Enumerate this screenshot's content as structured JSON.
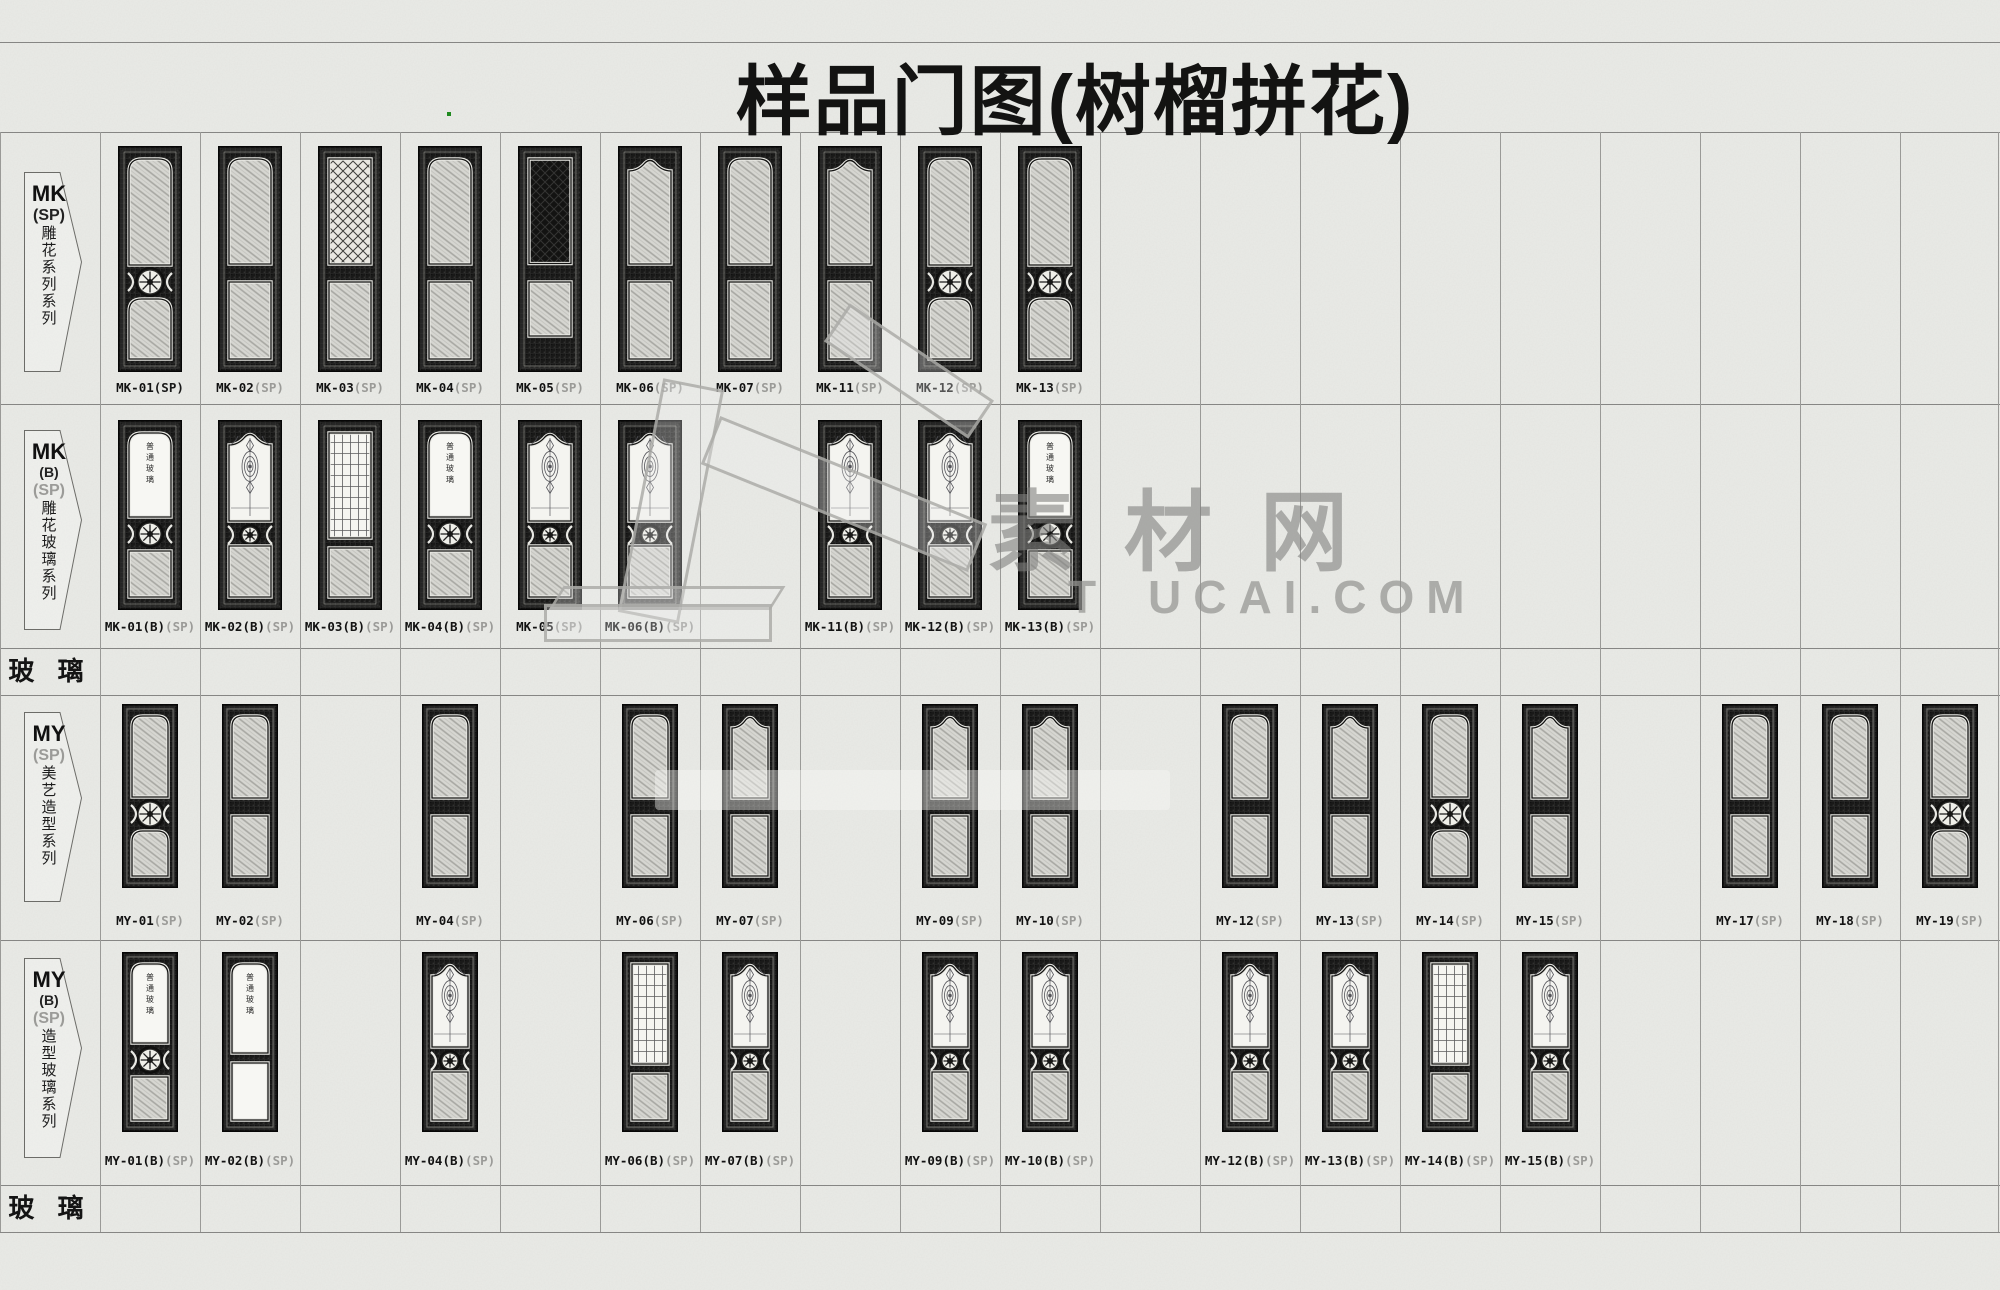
{
  "page_title": "样品门图(树榴拼花)",
  "glass_row_label": "玻 璃",
  "glass_pane_text": "普通玻璃",
  "watermark": {
    "cn_text": "素材网",
    "latin_fragment_1": "T",
    "latin_fragment_2": "UCAI.COM"
  },
  "rows": [
    {
      "id": "mk-sp",
      "badge": {
        "code": "MK",
        "variant": "",
        "series": "(SP)",
        "series_gray": false,
        "vertical": "雕花系列系列"
      },
      "doors": [
        {
          "col": 1,
          "name": "MK-01",
          "suffix": "(SP)",
          "style": "panel-rosette",
          "suffix_dark": true
        },
        {
          "col": 2,
          "name": "MK-02",
          "suffix": "(SP)",
          "style": "panel-plain"
        },
        {
          "col": 3,
          "name": "MK-03",
          "suffix": "(SP)",
          "style": "lattice"
        },
        {
          "col": 4,
          "name": "MK-04",
          "suffix": "(SP)",
          "style": "panel-plain"
        },
        {
          "col": 5,
          "name": "MK-05",
          "suffix": "(SP)",
          "style": "solid"
        },
        {
          "col": 6,
          "name": "MK-06",
          "suffix": "(SP)",
          "style": "panel-arch"
        },
        {
          "col": 7,
          "name": "MK-07",
          "suffix": "(SP)",
          "style": "panel-plain"
        },
        {
          "col": 8,
          "name": "MK-11",
          "suffix": "(SP)",
          "style": "panel-arch"
        },
        {
          "col": 9,
          "name": "MK-12",
          "suffix": "(SP)",
          "style": "panel-rosette"
        },
        {
          "col": 10,
          "name": "MK-13",
          "suffix": "(SP)",
          "style": "panel-rosette"
        }
      ]
    },
    {
      "id": "mk-b-sp",
      "badge": {
        "code": "MK",
        "variant": "(B)",
        "series": "(SP)",
        "series_gray": true,
        "vertical": "雕花玻璃系列"
      },
      "doors": [
        {
          "col": 1,
          "name": "MK-01(B)",
          "suffix": "(SP)",
          "style": "glass-plain",
          "pane_text": true
        },
        {
          "col": 2,
          "name": "MK-02(B)",
          "suffix": "(SP)",
          "style": "glass-ornate"
        },
        {
          "col": 3,
          "name": "MK-03(B)",
          "suffix": "(SP)",
          "style": "glass-lattice"
        },
        {
          "col": 4,
          "name": "MK-04(B)",
          "suffix": "(SP)",
          "style": "glass-plain",
          "pane_text": true
        },
        {
          "col": 5,
          "name": "MK-05",
          "suffix": "(SP)",
          "style": "glass-ornate"
        },
        {
          "col": 6,
          "name": "MK-06(B)",
          "suffix": "(SP)",
          "style": "glass-ornate"
        },
        {
          "col": 8,
          "name": "MK-11(B)",
          "suffix": "(SP)",
          "style": "glass-ornate"
        },
        {
          "col": 9,
          "name": "MK-12(B)",
          "suffix": "(SP)",
          "style": "glass-ornate"
        },
        {
          "col": 10,
          "name": "MK-13(B)",
          "suffix": "(SP)",
          "style": "glass-plain",
          "pane_text": true
        }
      ]
    },
    {
      "id": "my-sp",
      "badge": {
        "code": "MY",
        "variant": "",
        "series": "(SP)",
        "series_gray": true,
        "vertical": "美艺造型系列"
      },
      "doors": [
        {
          "col": 1,
          "name": "MY-01",
          "suffix": "(SP)",
          "style": "panel-rosette"
        },
        {
          "col": 2,
          "name": "MY-02",
          "suffix": "(SP)",
          "style": "panel-plain"
        },
        {
          "col": 4,
          "name": "MY-04",
          "suffix": "(SP)",
          "style": "panel-plain"
        },
        {
          "col": 6,
          "name": "MY-06",
          "suffix": "(SP)",
          "style": "panel-plain"
        },
        {
          "col": 7,
          "name": "MY-07",
          "suffix": "(SP)",
          "style": "panel-arch"
        },
        {
          "col": 9,
          "name": "MY-09",
          "suffix": "(SP)",
          "style": "panel-arch"
        },
        {
          "col": 10,
          "name": "MY-10",
          "suffix": "(SP)",
          "style": "panel-arch"
        },
        {
          "col": 12,
          "name": "MY-12",
          "suffix": "(SP)",
          "style": "panel-plain"
        },
        {
          "col": 13,
          "name": "MY-13",
          "suffix": "(SP)",
          "style": "panel-arch"
        },
        {
          "col": 14,
          "name": "MY-14",
          "suffix": "(SP)",
          "style": "panel-rosette"
        },
        {
          "col": 15,
          "name": "MY-15",
          "suffix": "(SP)",
          "style": "panel-arch"
        },
        {
          "col": 17,
          "name": "MY-17",
          "suffix": "(SP)",
          "style": "panel-plain"
        },
        {
          "col": 18,
          "name": "MY-18",
          "suffix": "(SP)",
          "style": "panel-plain"
        },
        {
          "col": 19,
          "name": "MY-19",
          "suffix": "(SP)",
          "style": "panel-rosette"
        }
      ]
    },
    {
      "id": "my-b-sp",
      "badge": {
        "code": "MY",
        "variant": "(B)",
        "series": "(SP)",
        "series_gray": true,
        "vertical": "造型玻璃系列"
      },
      "doors": [
        {
          "col": 1,
          "name": "MY-01(B)",
          "suffix": "(SP)",
          "style": "glass-plain",
          "pane_text": true
        },
        {
          "col": 2,
          "name": "MY-02(B)",
          "suffix": "(SP)",
          "style": "glass-plain2",
          "pane_text": true
        },
        {
          "col": 4,
          "name": "MY-04(B)",
          "suffix": "(SP)",
          "style": "glass-ornate"
        },
        {
          "col": 6,
          "name": "MY-06(B)",
          "suffix": "(SP)",
          "style": "glass-lattice"
        },
        {
          "col": 7,
          "name": "MY-07(B)",
          "suffix": "(SP)",
          "style": "glass-ornate"
        },
        {
          "col": 9,
          "name": "MY-09(B)",
          "suffix": "(SP)",
          "style": "glass-ornate"
        },
        {
          "col": 10,
          "name": "MY-10(B)",
          "suffix": "(SP)",
          "style": "glass-ornate"
        },
        {
          "col": 12,
          "name": "MY-12(B)",
          "suffix": "(SP)",
          "style": "glass-ornate"
        },
        {
          "col": 13,
          "name": "MY-13(B)",
          "suffix": "(SP)",
          "style": "glass-ornate"
        },
        {
          "col": 14,
          "name": "MY-14(B)",
          "suffix": "(SP)",
          "style": "glass-lattice"
        },
        {
          "col": 15,
          "name": "MY-15(B)",
          "suffix": "(SP)",
          "style": "glass-ornate"
        }
      ]
    }
  ]
}
